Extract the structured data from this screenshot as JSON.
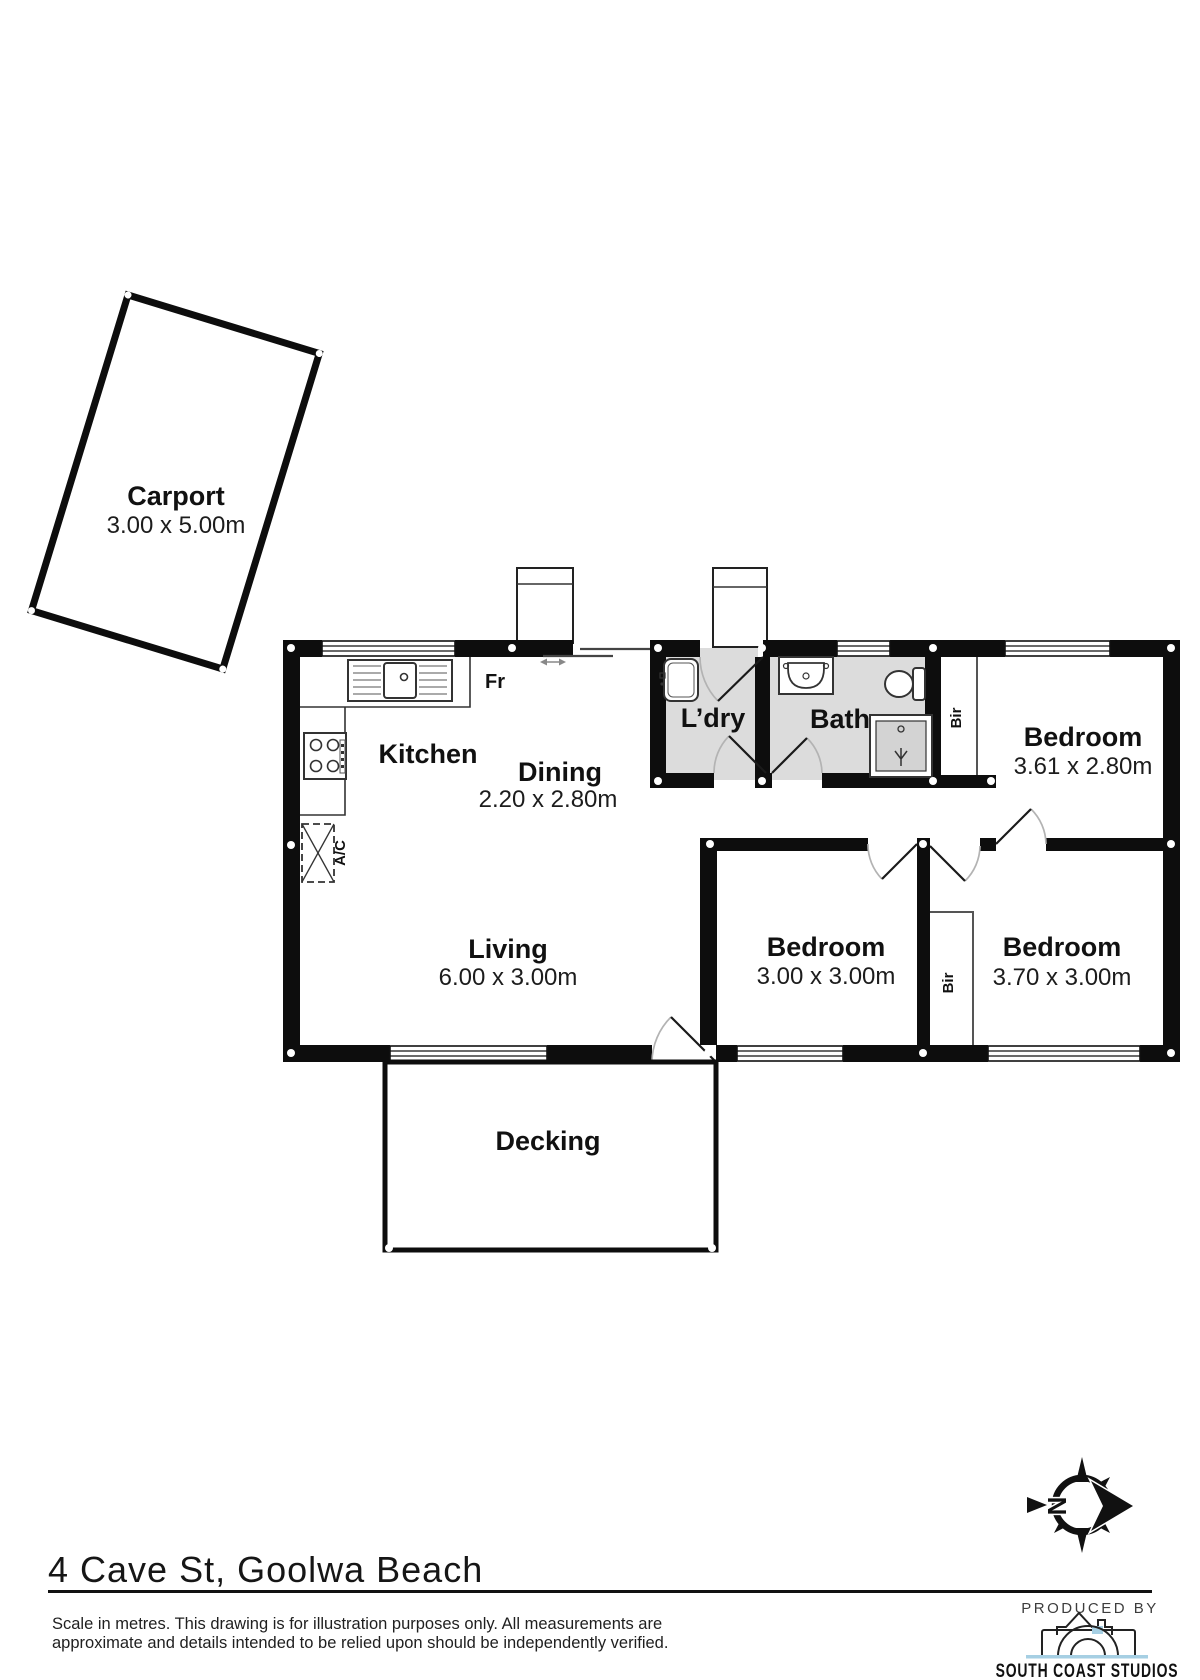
{
  "floorplan": {
    "carport": {
      "label": "Carport",
      "dims": "3.00 x 5.00m"
    },
    "kitchen": {
      "label": "Kitchen"
    },
    "dining": {
      "label": "Dining",
      "dims": "2.20 x 2.80m"
    },
    "laundry": {
      "label": "L’dry"
    },
    "bath": {
      "label": "Bath"
    },
    "bedroom1": {
      "label": "Bedroom",
      "dims": "3.61 x 2.80m"
    },
    "living": {
      "label": "Living",
      "dims": "6.00 x 3.00m"
    },
    "bedroom2": {
      "label": "Bedroom",
      "dims": "3.00 x 3.00m"
    },
    "bedroom3": {
      "label": "Bedroom",
      "dims": "3.70 x 3.00m"
    },
    "decking": {
      "label": "Decking"
    },
    "annotations": {
      "fridge": "Fr",
      "ac": "A/C",
      "robe1": "Bir",
      "robe2": "Bir",
      "north": "N"
    }
  },
  "footer": {
    "address": "4 Cave St, Goolwa Beach",
    "disclaimer_line1": "Scale in metres. This drawing is for illustration purposes only. All measurements are",
    "disclaimer_line2": "approximate and details intended to be relied upon should be independently verified."
  },
  "branding": {
    "produced_by": "PRODUCED BY",
    "studio_name": "SOUTH COAST STUDIOS"
  },
  "colors": {
    "wall": "#0d0d0d",
    "wet_area_floor": "#dcdcdc",
    "logo_accent_blue": "#a6cfe3",
    "background": "#ffffff"
  }
}
